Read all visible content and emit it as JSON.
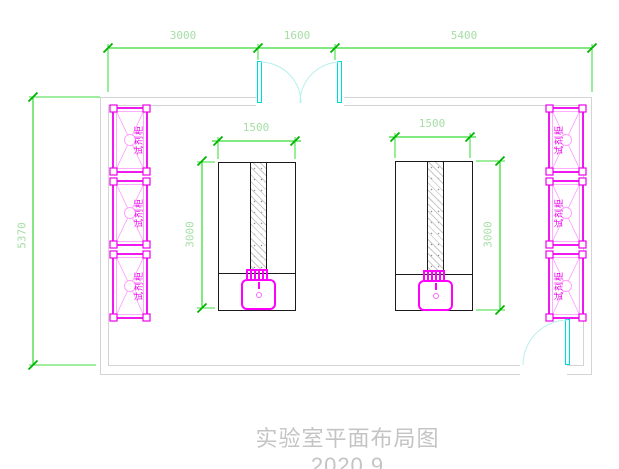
{
  "drawing": {
    "title": "实验室平面布局图2020.9"
  },
  "dimensions": {
    "top_widths": [
      "3000",
      "1600",
      "5400"
    ],
    "room_depth": "5370",
    "bench_width": "1500",
    "bench_depth": "3000"
  },
  "cabinets": {
    "left": [
      "试剂柜",
      "试剂柜",
      "试剂柜"
    ],
    "right": [
      "试剂柜",
      "试剂柜",
      "试剂柜"
    ]
  },
  "colors": {
    "dimension_line": "#00d400",
    "dimension_text": "#a5dea5",
    "wall": "#d4d4d4",
    "door": "#00d8d8",
    "door_swing": "#b6f0ec",
    "cabinet": "#ee00ee",
    "cabinet_detail": "#ff9aff",
    "bench_outline": "#1a1a1a",
    "sink": "#ff00ff",
    "title_text": "#c4c4c4",
    "background": "#ffffff"
  }
}
